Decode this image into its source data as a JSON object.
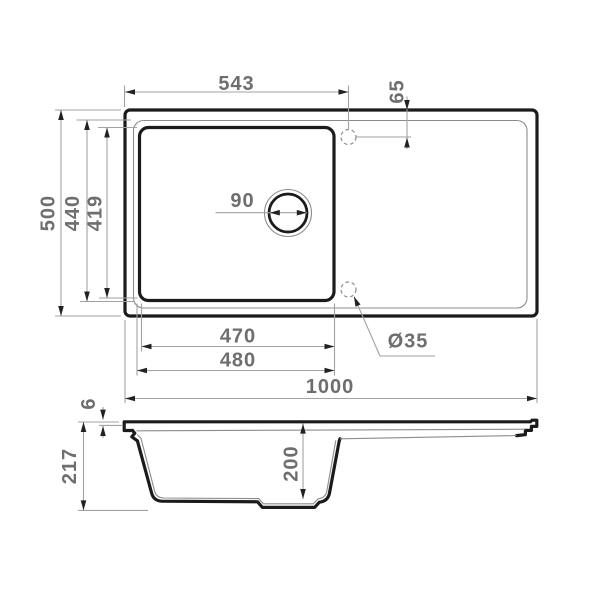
{
  "top_view": {
    "overall_width_label": "1000",
    "overall_depth_label": "500",
    "bowl_center_offset_label": "543",
    "tap_hole_offset_label": "65",
    "bowl_depth_outer_label": "440",
    "bowl_depth_inner_label": "419",
    "bowl_width_inner_label": "470",
    "bowl_width_outer_label": "480",
    "drain_diameter_label": "90",
    "tap_hole_diameter_label": "Ø35"
  },
  "side_view": {
    "overall_height_label": "217",
    "deck_thickness_label": "6",
    "bowl_depth_label": "200"
  },
  "colors": {
    "outline": "#1b1b1b",
    "thin-line": "#8c8c8c",
    "dim-line": "#a2a2a2",
    "arrow": "#222222",
    "label": "#6e6e6e",
    "background": "#ffffff"
  }
}
